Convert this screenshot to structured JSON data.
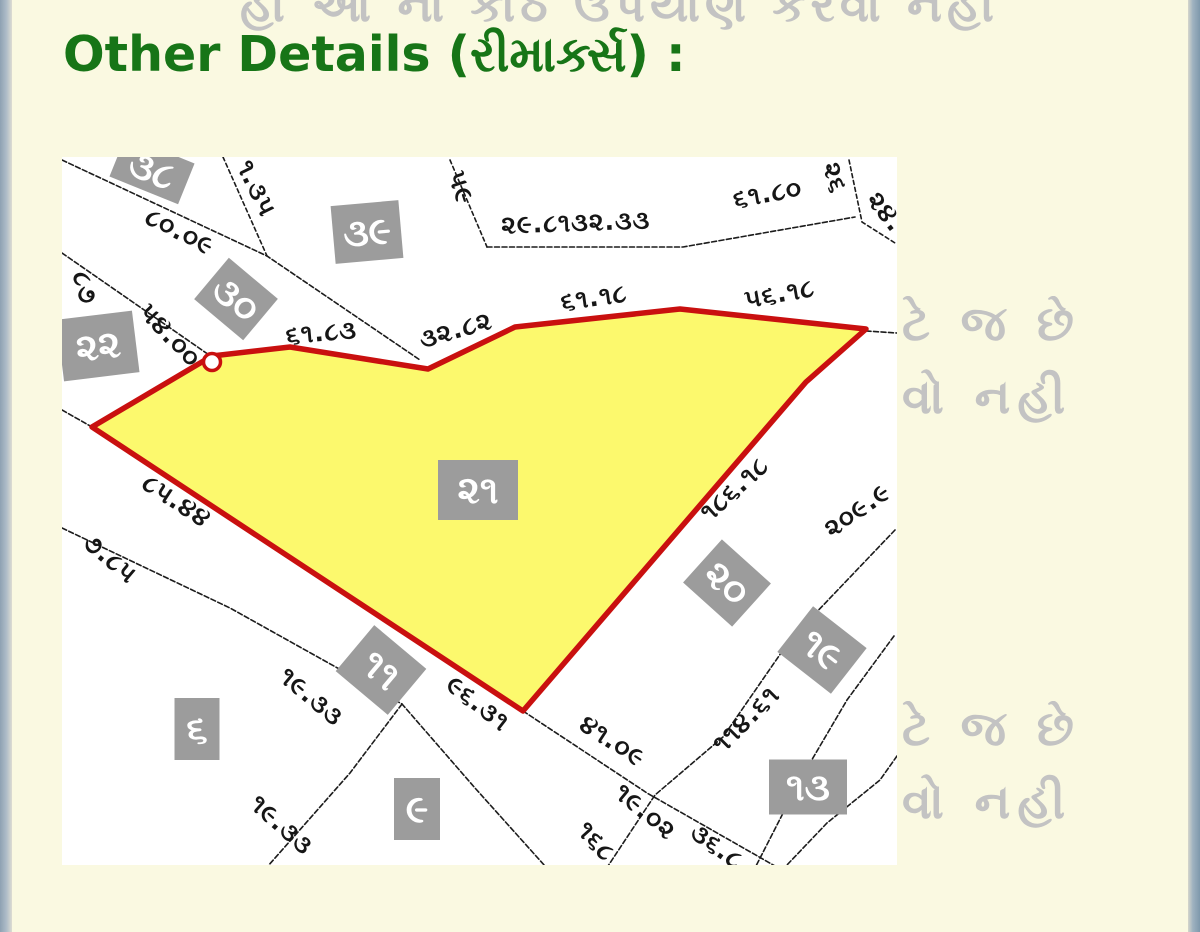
{
  "page": {
    "title": "Other Details (રીમાર્ક્સ) :",
    "title_color": "#177517",
    "background": "#FAF9E1"
  },
  "watermark": {
    "color": "#C3C3C3",
    "top": "હા આ ના કોઠ ઉપયાણ કરવા નહી",
    "right_rows": [
      "ટે જ છે",
      "વો નહી",
      "ટે જ છે",
      "વો નહી"
    ]
  },
  "map": {
    "highlight_plot_number": "૨૧",
    "colors": {
      "plot_fill": "#FCF96D",
      "plot_outline": "#C9100F",
      "box_bg": "#9C9C9C",
      "box_text": "#FFFFFF",
      "line": "#1C1C1C",
      "map_bg": "#FFFFFF"
    },
    "boxes": [
      {
        "label": "૩૮",
        "x": 152,
        "y": 170,
        "w": 74,
        "h": 44,
        "rot": 22
      },
      {
        "label": "૩૯",
        "x": 367,
        "y": 232,
        "w": 68,
        "h": 58,
        "rot": -5
      },
      {
        "label": "૩૦",
        "x": 236,
        "y": 299,
        "w": 64,
        "h": 54,
        "rot": 40
      },
      {
        "label": "૨૨",
        "x": 98,
        "y": 346,
        "w": 76,
        "h": 62,
        "rot": -7
      },
      {
        "label": "૨૧",
        "x": 478,
        "y": 490,
        "w": 80,
        "h": 60,
        "rot": 0
      },
      {
        "label": "૨૦",
        "x": 727,
        "y": 583,
        "w": 66,
        "h": 58,
        "rot": 42
      },
      {
        "label": "૧૯",
        "x": 822,
        "y": 650,
        "w": 68,
        "h": 58,
        "rot": 38
      },
      {
        "label": "૧૧",
        "x": 381,
        "y": 670,
        "w": 68,
        "h": 60,
        "rot": 40
      },
      {
        "label": "૬",
        "x": 197,
        "y": 729,
        "w": 45,
        "h": 62,
        "rot": 0
      },
      {
        "label": "૯",
        "x": 417,
        "y": 809,
        "w": 46,
        "h": 62,
        "rot": 0
      },
      {
        "label": "૧૩",
        "x": 808,
        "y": 787,
        "w": 78,
        "h": 55,
        "rot": 0
      }
    ],
    "labels": [
      {
        "text": "૮૦.૦૯",
        "x": 176,
        "y": 239,
        "rot": 27
      },
      {
        "text": "૧.૩૫",
        "x": 249,
        "y": 192,
        "rot": 64
      },
      {
        "text": "૮૭",
        "x": 77,
        "y": 290,
        "rot": 74
      },
      {
        "text": "૫૪.૦૦",
        "x": 164,
        "y": 341,
        "rot": 47
      },
      {
        "text": "૫૯",
        "x": 453,
        "y": 190,
        "rot": 72
      },
      {
        "text": "૨૯.૮૧૩૨.૩૩",
        "x": 576,
        "y": 231,
        "rot": -2
      },
      {
        "text": "૬૧.૮૦",
        "x": 769,
        "y": 202,
        "rot": -10
      },
      {
        "text": "૨૬",
        "x": 827,
        "y": 180,
        "rot": 74
      },
      {
        "text": "૨૪.",
        "x": 879,
        "y": 217,
        "rot": 52
      },
      {
        "text": "૬૧.૮૩",
        "x": 322,
        "y": 341,
        "rot": -5
      },
      {
        "text": "૩૨.૮૨",
        "x": 458,
        "y": 338,
        "rot": -16
      },
      {
        "text": "૬૧.૧૮",
        "x": 595,
        "y": 306,
        "rot": -8
      },
      {
        "text": "૫૬.૧૮",
        "x": 781,
        "y": 302,
        "rot": -10
      },
      {
        "text": "૮૫.૪૪",
        "x": 172,
        "y": 508,
        "rot": 33
      },
      {
        "text": "૭.૮૫",
        "x": 105,
        "y": 565,
        "rot": 40
      },
      {
        "text": "૧૮૬.૧૮",
        "x": 740,
        "y": 495,
        "rot": -42
      },
      {
        "text": "૨૦૯.૯",
        "x": 862,
        "y": 517,
        "rot": -35
      },
      {
        "text": "૧૯.૩૩",
        "x": 306,
        "y": 703,
        "rot": 40
      },
      {
        "text": "૧૯.૩૩",
        "x": 276,
        "y": 831,
        "rot": 42
      },
      {
        "text": "૯૬.૩૧",
        "x": 473,
        "y": 710,
        "rot": 38
      },
      {
        "text": "૪૧.૦૯",
        "x": 608,
        "y": 748,
        "rot": 33
      },
      {
        "text": "૧૯.૦૨",
        "x": 640,
        "y": 818,
        "rot": 40
      },
      {
        "text": "૩૬.૮",
        "x": 712,
        "y": 853,
        "rot": 36
      },
      {
        "text": "૧૬૮",
        "x": 590,
        "y": 847,
        "rot": 48
      },
      {
        "text": "૧૧૪.૬૧",
        "x": 752,
        "y": 725,
        "rot": -45
      }
    ]
  }
}
